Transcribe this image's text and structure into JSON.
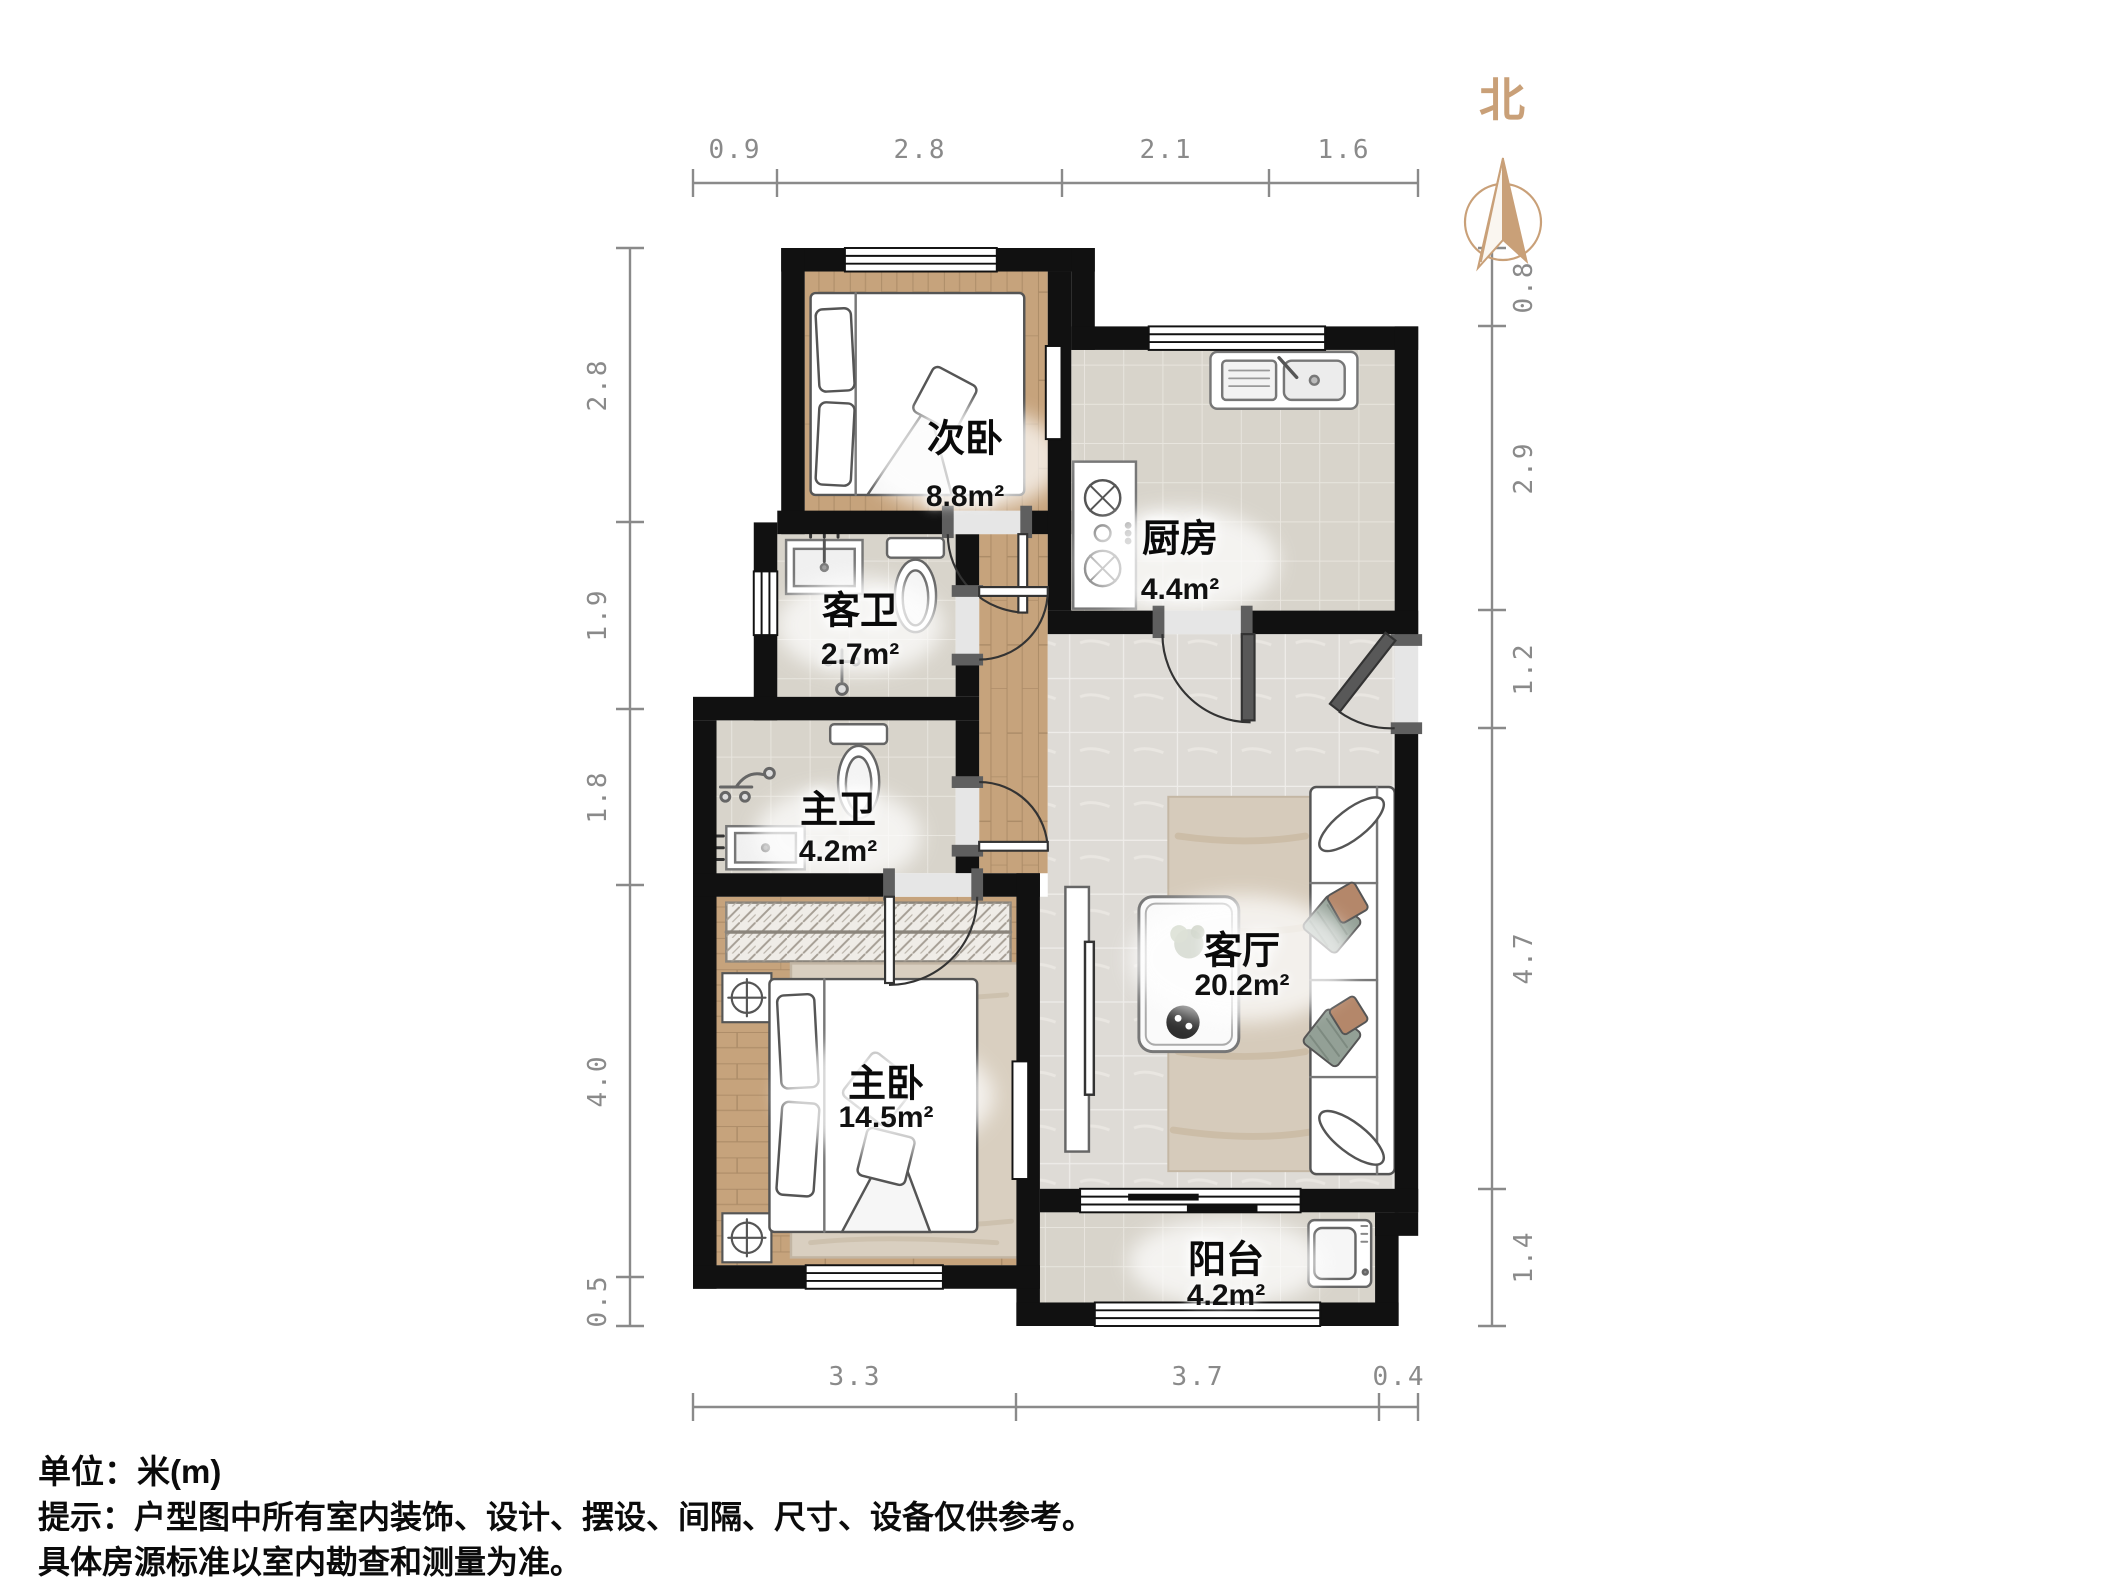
{
  "north": {
    "label": "北"
  },
  "rooms": [
    {
      "id": "secondary-bedroom",
      "name": "次卧",
      "area": "8.8m²"
    },
    {
      "id": "kitchen",
      "name": "厨房",
      "area": "4.4m²"
    },
    {
      "id": "guest-bathroom",
      "name": "客卫",
      "area": "2.7m²"
    },
    {
      "id": "master-bathroom",
      "name": "主卫",
      "area": "4.2m²"
    },
    {
      "id": "master-bedroom",
      "name": "主卧",
      "area": "14.5m²"
    },
    {
      "id": "living-room",
      "name": "客厅",
      "area": "20.2m²"
    },
    {
      "id": "balcony",
      "name": "阳台",
      "area": "4.2m²"
    }
  ],
  "dimensions": {
    "top": [
      "0.9",
      "2.8",
      "2.1",
      "1.6"
    ],
    "left": [
      "2.8",
      "1.9",
      "1.8",
      "4.0",
      "0.5"
    ],
    "right": [
      "0.8",
      "2.9",
      "1.2",
      "4.7",
      "1.4"
    ],
    "bottom": [
      "3.3",
      "3.7",
      "0.4"
    ]
  },
  "footer": {
    "unit": "单位：米(m)",
    "tip1": "提示：户型图中所有室内装饰、设计、摆设、间隔、尺寸、设备仅供参考。",
    "tip2": "具体房源标准以室内勘查和测量为准。"
  },
  "colors": {
    "wall": "#111111",
    "wood": "#c3a17c",
    "tile": "#dedbd6",
    "bath-tile": "#d8d4cb",
    "dim": "#8a8a8a",
    "accent": "#c9a078"
  }
}
